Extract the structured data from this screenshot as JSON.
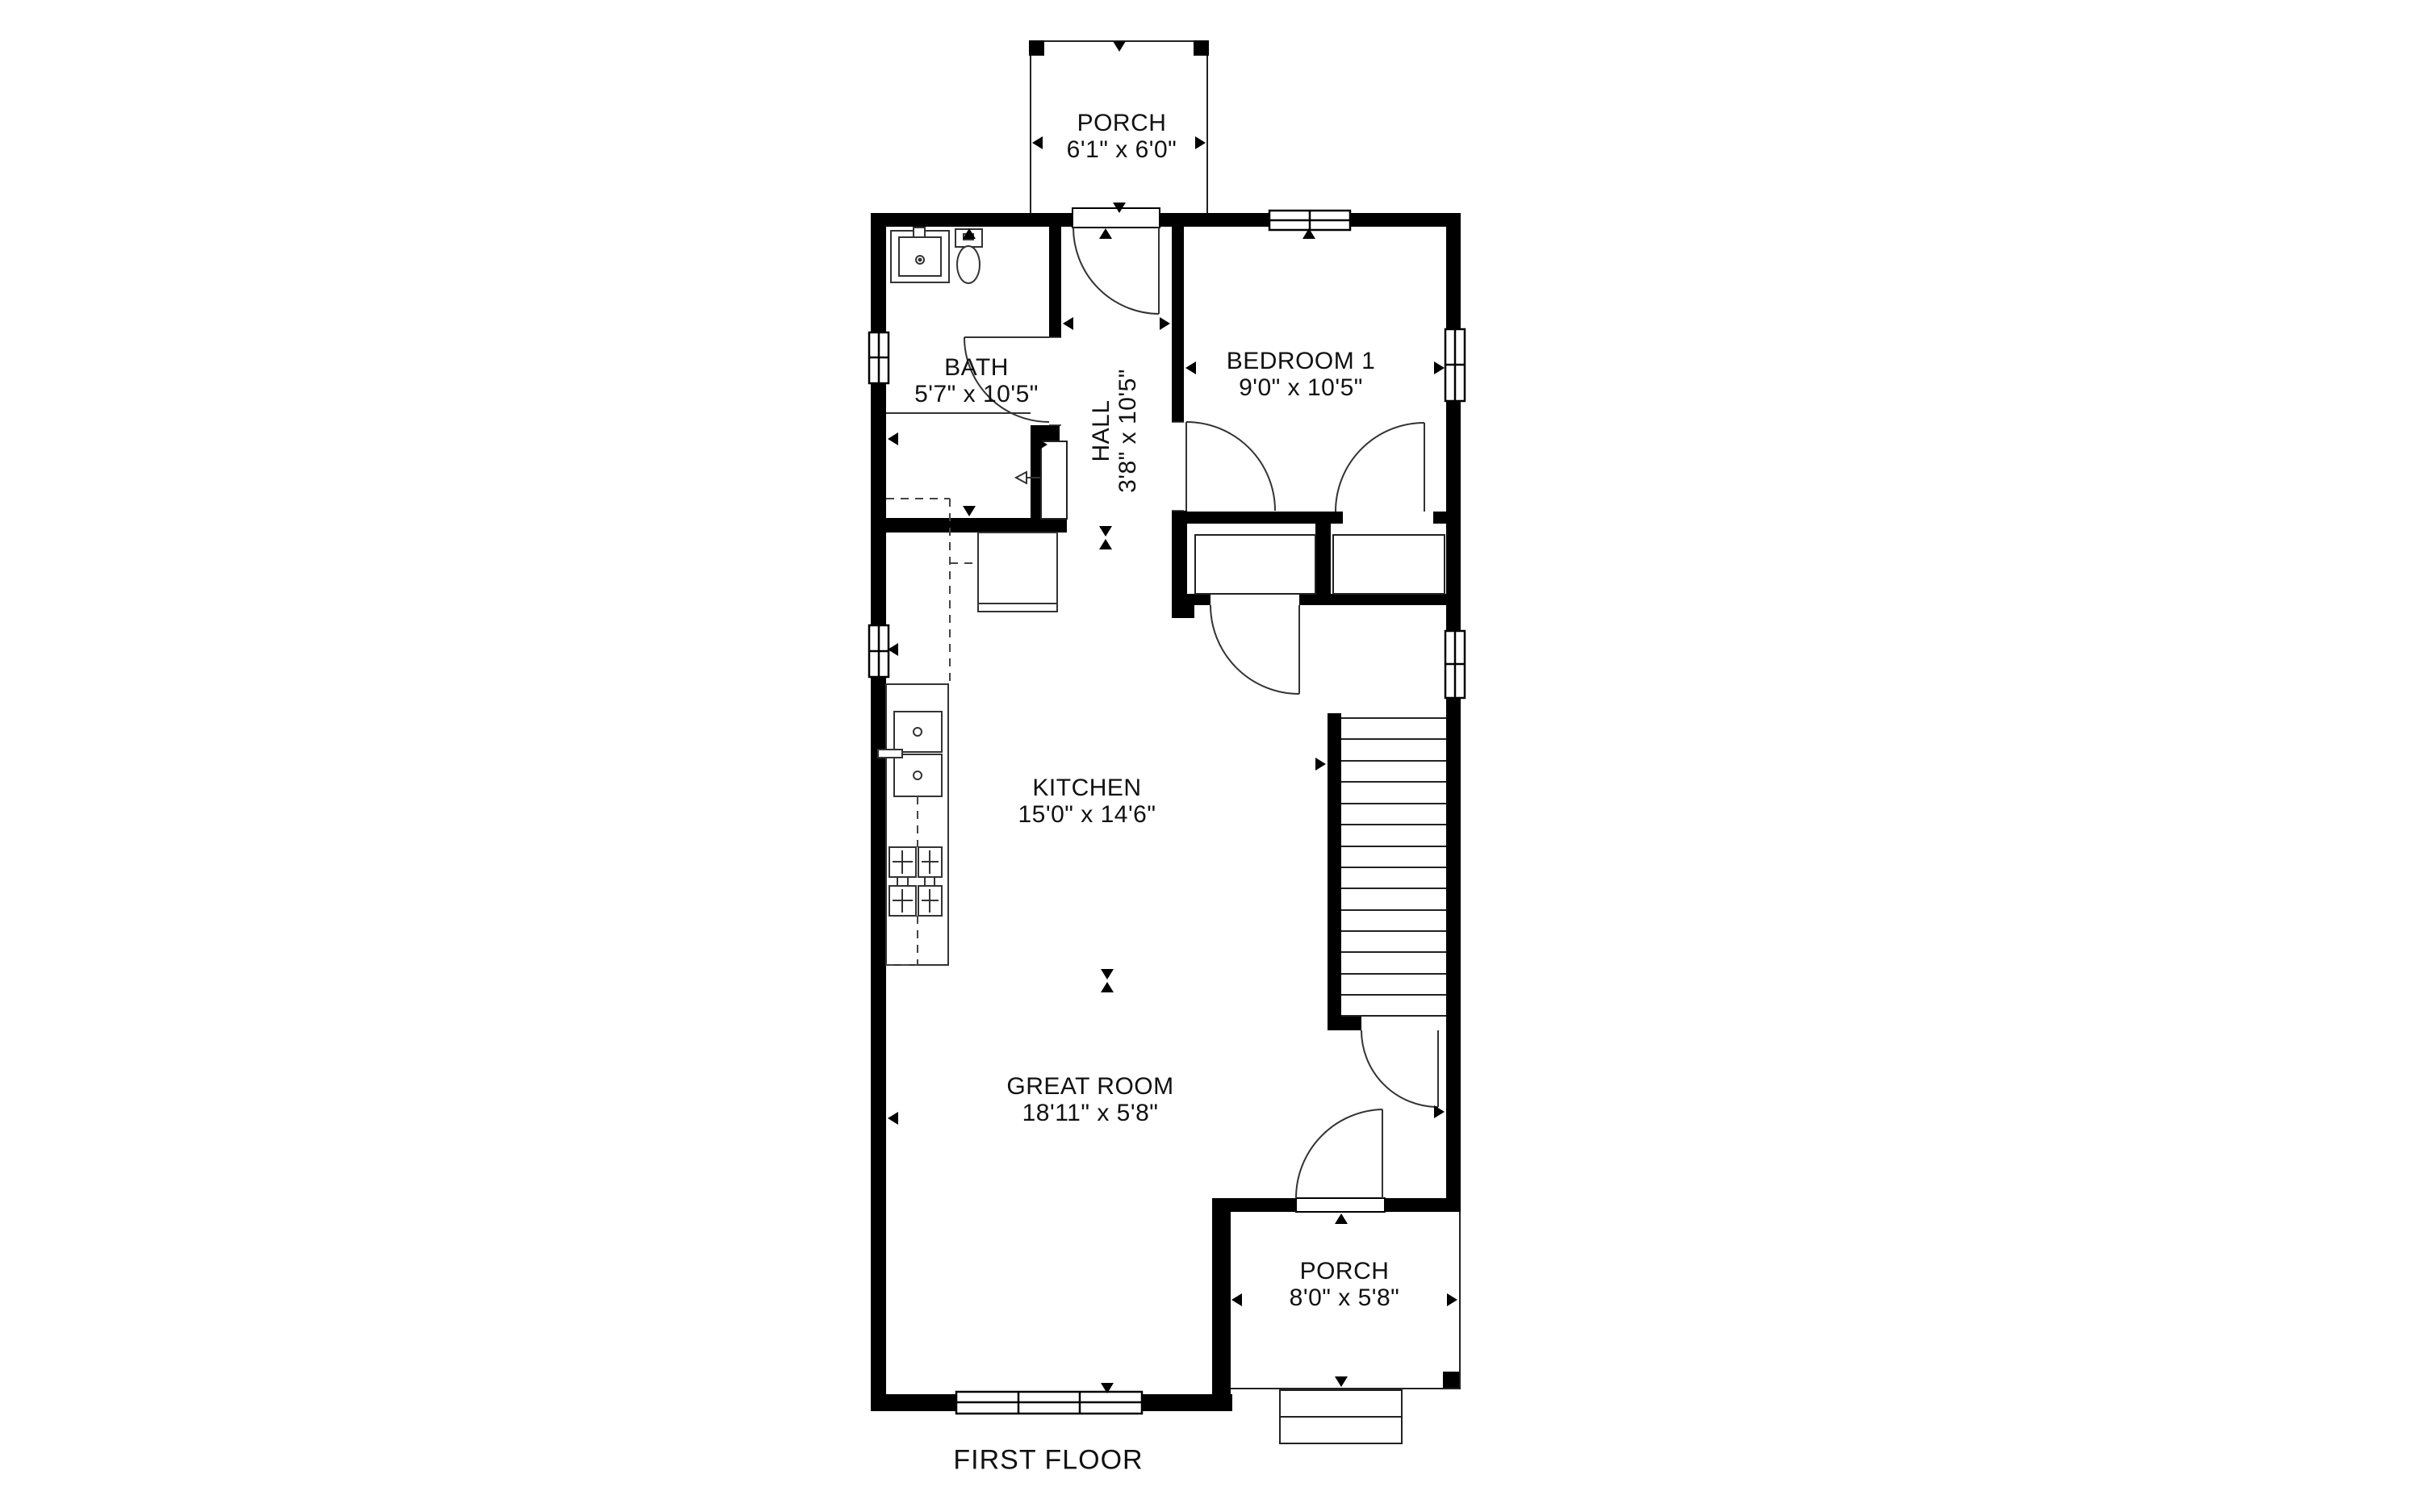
{
  "plan": {
    "floor_label": "FIRST FLOOR",
    "rooms": {
      "porch_top": {
        "name": "PORCH",
        "dims": "6'1\" x 6'0\""
      },
      "bath": {
        "name": "BATH",
        "dims": "5'7\" x 10'5\""
      },
      "hall": {
        "name": "HALL",
        "dims": "3'8\" x 10'5\""
      },
      "bedroom1": {
        "name": "BEDROOM 1",
        "dims": "9'0\" x 10'5\""
      },
      "kitchen": {
        "name": "KITCHEN",
        "dims": "15'0\" x 14'6\""
      },
      "great_room": {
        "name": "GREAT ROOM",
        "dims": "18'11\" x 5'8\""
      },
      "porch_bottom": {
        "name": "PORCH",
        "dims": "8'0\" x 5'8\""
      }
    },
    "colors": {
      "wall": "#000000",
      "background": "#ffffff",
      "line": "#222222"
    }
  }
}
